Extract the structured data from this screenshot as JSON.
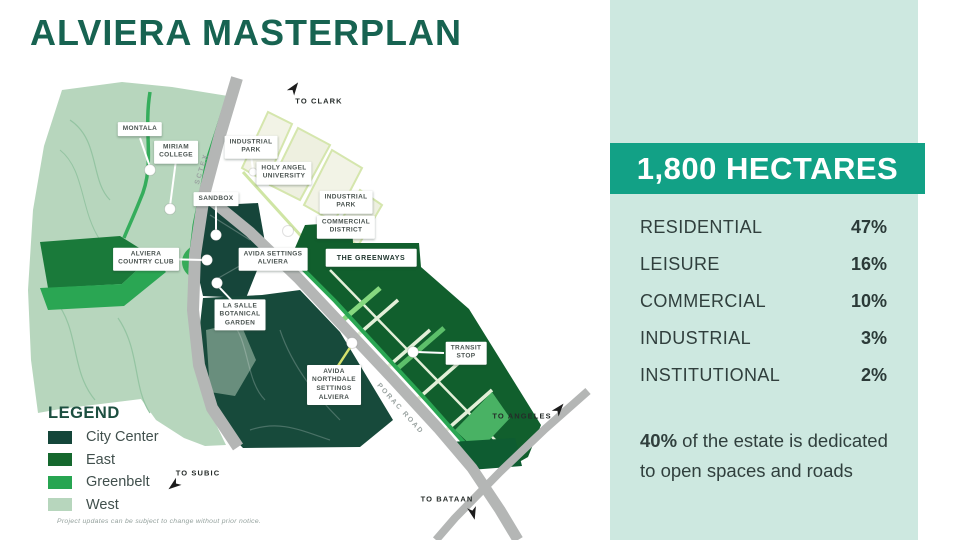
{
  "title": "ALVIERA MASTERPLAN",
  "panel": {
    "headline": "1,800 HECTARES",
    "stats": [
      {
        "label": "RESIDENTIAL",
        "value": "47%"
      },
      {
        "label": "LEISURE",
        "value": "16%"
      },
      {
        "label": "COMMERCIAL",
        "value": "10%"
      },
      {
        "label": "INDUSTRIAL",
        "value": "3%"
      },
      {
        "label": "INSTITUTIONAL",
        "value": "2%"
      }
    ],
    "note": {
      "bold": "40%",
      "line1_rest": " of the estate is dedicated",
      "line2": "to open spaces and roads"
    },
    "colors": {
      "panel_bg": "#cde8e0",
      "banner_bg": "#12a186",
      "banner_text": "#ffffff"
    }
  },
  "map": {
    "labels": {
      "montala": [
        "MONTALA"
      ],
      "miriam_college": [
        "MIRIAM",
        "COLLEGE"
      ],
      "sandbox": [
        "SANDBOX"
      ],
      "industrial_park_north": [
        "INDUSTRIAL",
        "PARK"
      ],
      "holy_angel_university": [
        "HOLY ANGEL",
        "UNIVERSITY"
      ],
      "industrial_park_east": [
        "INDUSTRIAL",
        "PARK"
      ],
      "commercial_district": [
        "COMMERCIAL",
        "DISTRICT"
      ],
      "avida_settings_alviera": [
        "AVIDA SETTINGS",
        "ALVIERA"
      ],
      "the_greenways": [
        "THE GREENWAYS"
      ],
      "alviera_country_club": [
        "ALVIERA",
        "COUNTRY CLUB"
      ],
      "la_salle_botanical_garden": [
        "LA SALLE",
        "BOTANICAL",
        "GARDEN"
      ],
      "avida_northdale_settings_alviera": [
        "AVIDA",
        "NORTHDALE",
        "SETTINGS",
        "ALVIERA"
      ],
      "transit_stop": [
        "TRANSIT",
        "STOP"
      ]
    },
    "roads": {
      "sctex": "SCTEX",
      "porac": "PORAC ROAD"
    },
    "directions": {
      "clark": "TO CLARK",
      "subic": "TO SUBIC",
      "angeles": "TO ANGELES",
      "bataan": "TO BATAAN"
    }
  },
  "legend": {
    "title": "LEGEND",
    "items": [
      {
        "label": "City Center",
        "color": "#14463a"
      },
      {
        "label": "East",
        "color": "#15682e"
      },
      {
        "label": "Greenbelt",
        "color": "#27a551"
      },
      {
        "label": "West",
        "color": "#b7d6bd"
      }
    ]
  },
  "disclaimer": "Project updates can be subject to change without prior notice."
}
